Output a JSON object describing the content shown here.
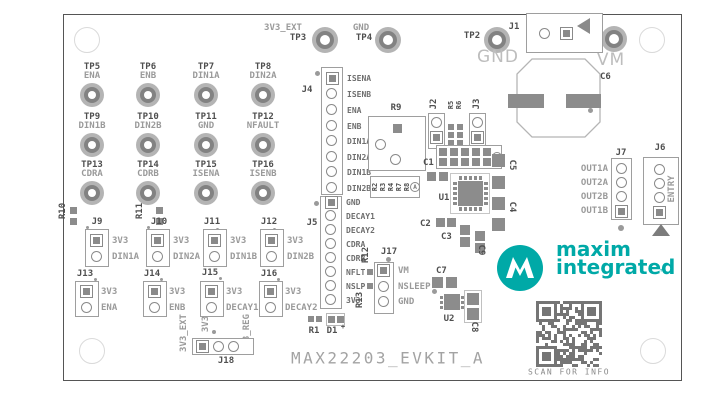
{
  "board": {
    "title": "MAX22203_EVKIT_A",
    "qr_caption": "SCAN FOR INFO"
  },
  "logo": {
    "monogram": "M",
    "line1": "maxim",
    "line2": "integrated",
    "tm": "™"
  },
  "colors": {
    "logo_teal": "#00a9a7",
    "silkscreen_dark": "#4f4f4f",
    "signal_gray": "#9a9a9a",
    "pad_gray": "#8c8c8c",
    "qr_gray": "#757575"
  },
  "top_testpoints": {
    "tp3": {
      "signal": "3V3_EXT",
      "id": "TP3"
    },
    "tp4": {
      "signal": "GND",
      "id": "TP4"
    },
    "tp2": {
      "id": "TP2",
      "rail": "GND"
    },
    "tp1": {
      "id": "TP1",
      "rail": "VM"
    }
  },
  "tp_grid": [
    {
      "id": "TP5",
      "signal": "ENA"
    },
    {
      "id": "TP6",
      "signal": "ENB"
    },
    {
      "id": "TP7",
      "signal": "DIN1A"
    },
    {
      "id": "TP8",
      "signal": "DIN2A"
    },
    {
      "id": "TP9",
      "signal": "DIN1B"
    },
    {
      "id": "TP10",
      "signal": "DIN2B"
    },
    {
      "id": "TP11",
      "signal": "GND"
    },
    {
      "id": "TP12",
      "signal": "NFAULT"
    },
    {
      "id": "TP13",
      "signal": "CDRA"
    },
    {
      "id": "TP14",
      "signal": "CDRB"
    },
    {
      "id": "TP15",
      "signal": "ISENA"
    },
    {
      "id": "TP16",
      "signal": "ISENB"
    }
  ],
  "jumpers": [
    {
      "id": "J9",
      "pin1": "3V3",
      "pin2": "DIN1A"
    },
    {
      "id": "J10",
      "pin1": "3V3",
      "pin2": "DIN2A"
    },
    {
      "id": "J11",
      "pin1": "3V3",
      "pin2": "DIN1B"
    },
    {
      "id": "J12",
      "pin1": "3V3",
      "pin2": "DIN2B"
    },
    {
      "id": "J13",
      "pin1": "3V3",
      "pin2": "ENA"
    },
    {
      "id": "J14",
      "pin1": "3V3",
      "pin2": "ENB"
    },
    {
      "id": "J15",
      "pin1": "3V3",
      "pin2": "DECAY1"
    },
    {
      "id": "J16",
      "pin1": "3V3",
      "pin2": "DECAY2"
    }
  ],
  "j4": {
    "id": "J4",
    "pins": [
      "ISENA",
      "ISENB",
      "ENA",
      "ENB",
      "DIN1A",
      "DIN2A",
      "DIN1B",
      "DIN2B"
    ]
  },
  "j5": {
    "id": "J5",
    "pins": [
      "GND",
      "DECAY1",
      "DECAY2",
      "CDRA",
      "CDRB",
      "NFLT",
      "NSLP",
      "3V3"
    ]
  },
  "j17": {
    "id": "J17",
    "pins": [
      "VM",
      "NSLEEP",
      "GND"
    ]
  },
  "j7": {
    "id": "J7",
    "pins": [
      "OUT1A",
      "OUT2A",
      "OUT2B",
      "OUT1B"
    ]
  },
  "j6": {
    "id": "J6",
    "label": "ENTRY"
  },
  "j18": {
    "id": "J18",
    "left": "3V3_EXT",
    "mid": "3V3",
    "right": "3V3_REG"
  },
  "j1": {
    "id": "J1"
  },
  "components": {
    "r9": "R9",
    "r10": "R10",
    "r11": "R11",
    "r12": "R12",
    "r13": "R13",
    "r5": "R5",
    "r6": "R6",
    "r1": "R1",
    "d1": "D1",
    "d1_polarity": "+",
    "u1": "U1",
    "u2": "U2",
    "c1": "C1",
    "c2": "C2",
    "c3": "C3",
    "c4": "C4",
    "c5": "C5",
    "c6": "C6",
    "c7": "C7",
    "c8": "C8",
    "c9": "C9",
    "j2": "J2",
    "j3": "J3",
    "array_marker": "A",
    "resistor_labels": [
      "R2",
      "R3",
      "R4",
      "R7",
      "R8"
    ]
  }
}
